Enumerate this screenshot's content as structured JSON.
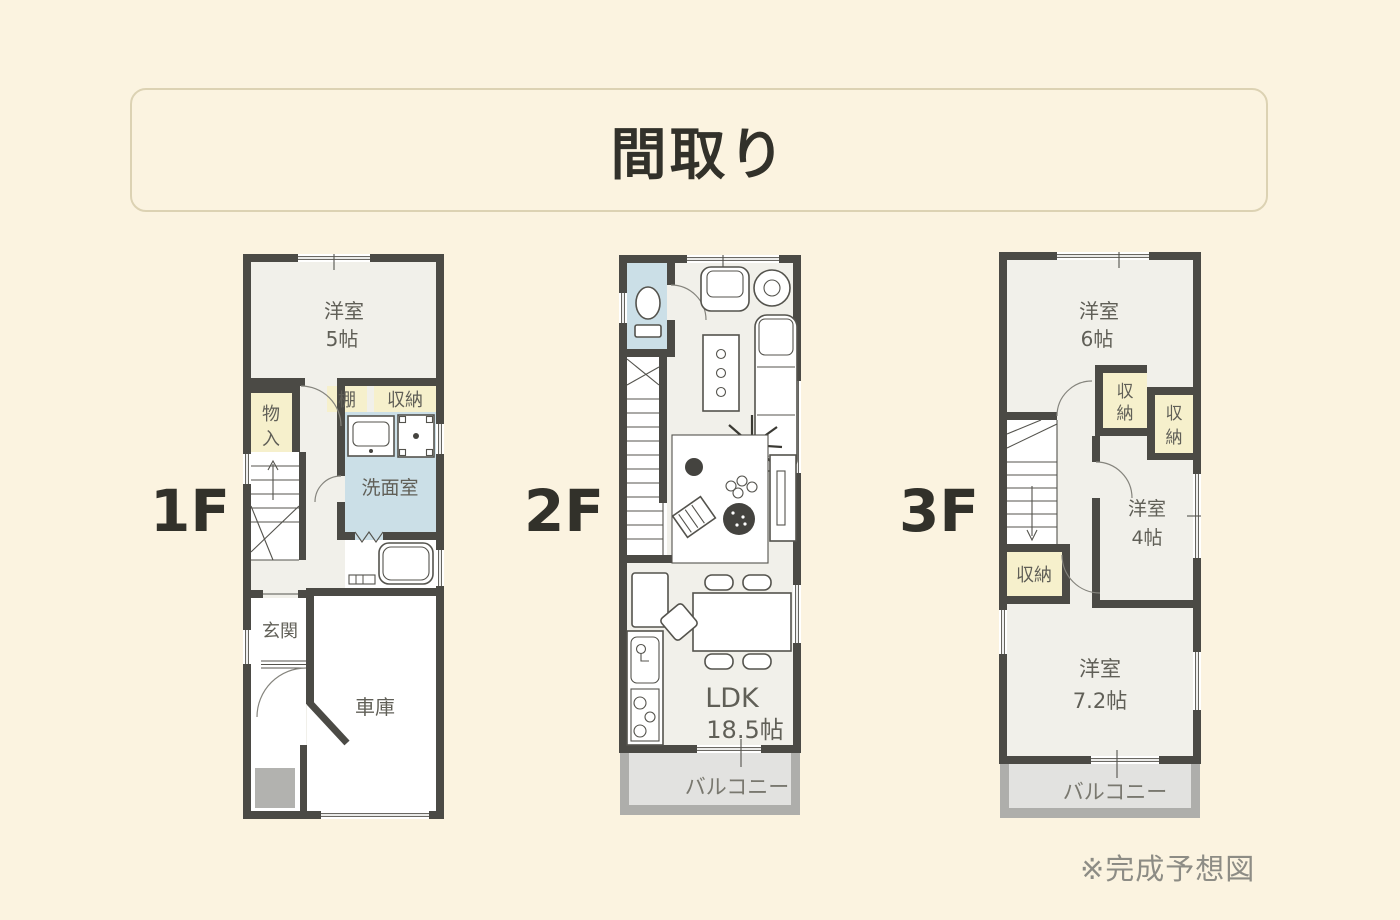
{
  "page": {
    "title": "間取り",
    "note": "※完成予想図"
  },
  "colors": {
    "background": "#FBF3E0",
    "title_border": "#DCD2B3",
    "title_text": "#32312A",
    "floor_label_text": "#32312A",
    "wall": "#4B4A45",
    "room_floor": "#F1F0EA",
    "storage_yellow": "#F6F0CC",
    "wet_blue": "#CBDFE7",
    "balcony_band": "#AEAEAB",
    "balcony_floor": "#E2E2E0",
    "room_label_text": "#605F57",
    "note_text": "#8D8C85"
  },
  "floors": [
    {
      "label": "1F",
      "rooms": {
        "western5_name": "洋室",
        "western5_size": "5帖",
        "storage_mono_1": "物",
        "storage_mono_2": "入",
        "shelf": "棚",
        "closet": "収納",
        "washroom": "洗面室",
        "entrance": "玄関",
        "garage": "車庫"
      }
    },
    {
      "label": "2F",
      "rooms": {
        "ldk_name": "LDK",
        "ldk_size": "18.5帖",
        "balcony": "バルコニー"
      }
    },
    {
      "label": "3F",
      "rooms": {
        "western6_name": "洋室",
        "western6_size": "6帖",
        "closet1_a": "収",
        "closet1_b": "納",
        "closet2_a": "収",
        "closet2_b": "納",
        "western4_name": "洋室",
        "western4_size": "4帖",
        "closet3": "収納",
        "western72_name": "洋室",
        "western72_size": "7.2帖",
        "balcony": "バルコニー"
      }
    }
  ]
}
